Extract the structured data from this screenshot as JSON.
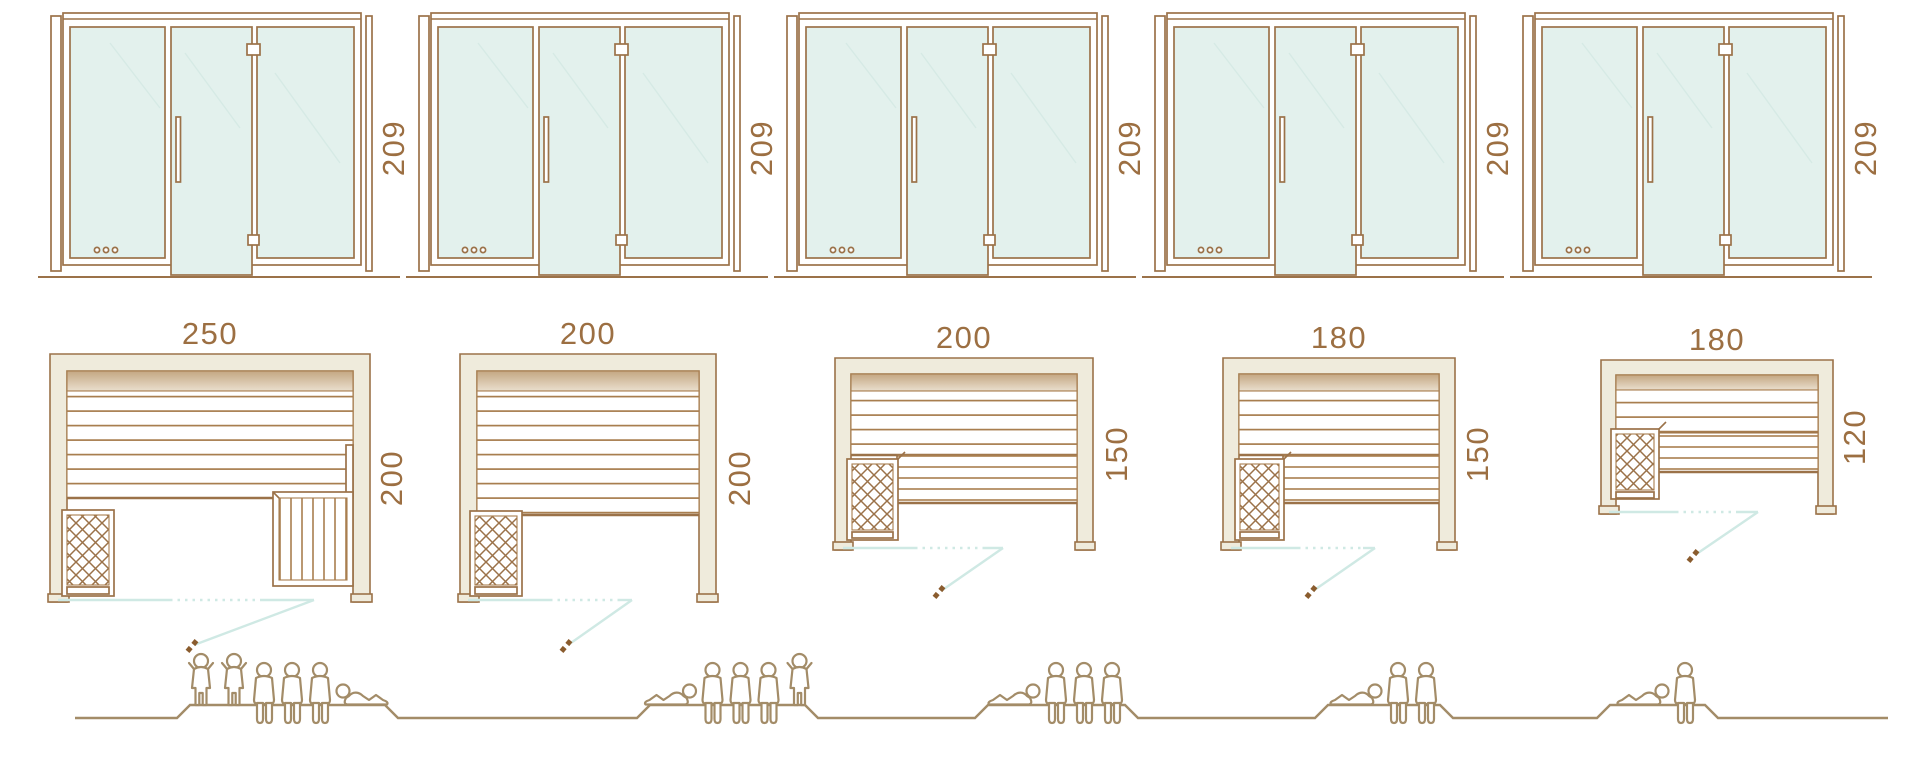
{
  "palette": {
    "outline_brown": "#9b7249",
    "dimension_text_brown": "#9c6f42",
    "glass_mint": "#e3f1ed",
    "wall_cream": "#efebdc",
    "bench_edge_tan": "#c4a782",
    "door_swing_teal": "#cfe9e4",
    "figure_brown": "#a38c68"
  },
  "units": [
    {
      "front_height_cm": "209",
      "plan_width_cm": "250",
      "plan_depth_cm": "200",
      "capacity": 6,
      "figures": [
        "standing",
        "standing",
        "sitting",
        "sitting",
        "sitting",
        "reclining-mirrored"
      ]
    },
    {
      "front_height_cm": "209",
      "plan_width_cm": "200",
      "plan_depth_cm": "200",
      "capacity": 5,
      "figures": [
        "reclining",
        "sitting",
        "sitting",
        "sitting",
        "standing"
      ]
    },
    {
      "front_height_cm": "209",
      "plan_width_cm": "200",
      "plan_depth_cm": "150",
      "capacity": 4,
      "figures": [
        "reclining",
        "sitting",
        "sitting",
        "sitting"
      ]
    },
    {
      "front_height_cm": "209",
      "plan_width_cm": "180",
      "plan_depth_cm": "150",
      "capacity": 3,
      "figures": [
        "reclining",
        "sitting",
        "sitting"
      ]
    },
    {
      "front_height_cm": "209",
      "plan_width_cm": "180",
      "plan_depth_cm": "120",
      "capacity": 2,
      "figures": [
        "reclining",
        "sitting"
      ]
    }
  ]
}
